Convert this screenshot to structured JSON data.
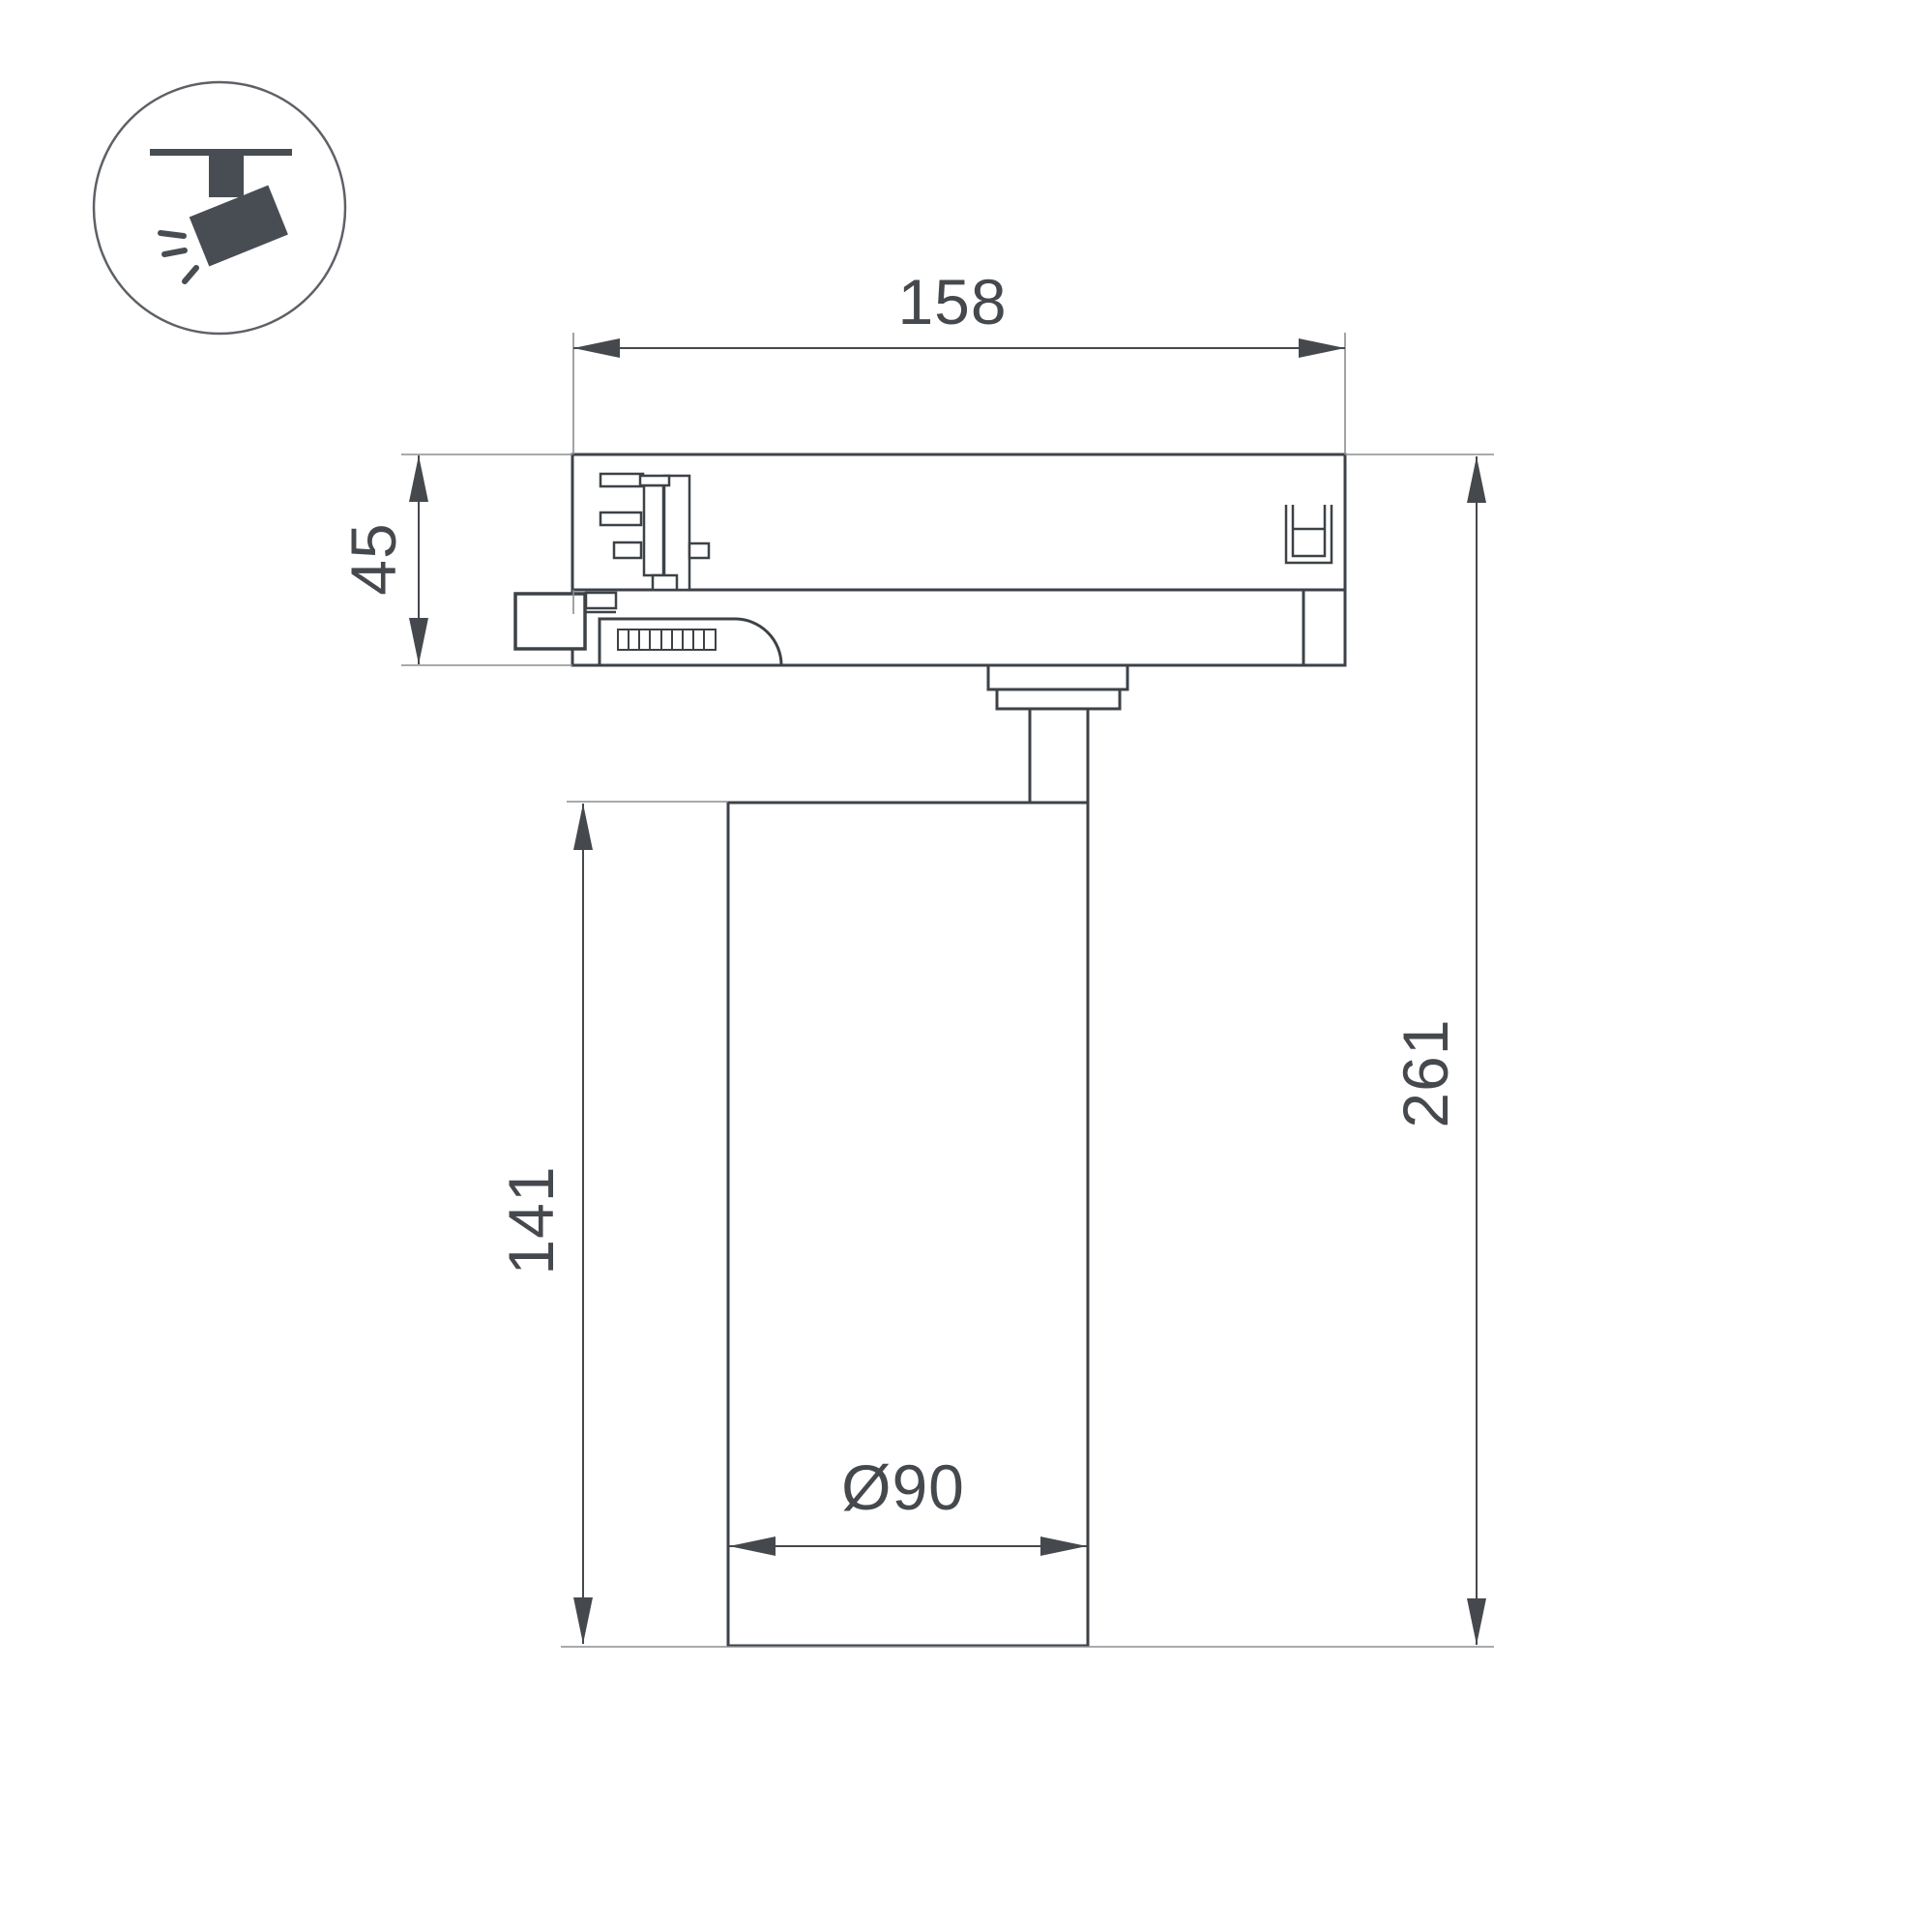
{
  "icon": {
    "name": "track-spotlight-icon"
  },
  "dimensions": {
    "track_adapter_width": "158",
    "adapter_height": "45",
    "body_height": "141",
    "total_height": "261",
    "body_diameter": "Ø90"
  },
  "colors": {
    "outline": "#3d4247",
    "detail": "#3d4247",
    "dimension": "#45494e",
    "extension": "#8b8e91",
    "icon_fill": "#474d53",
    "icon_circle": "#5d6166",
    "surface": "#ffffff"
  }
}
